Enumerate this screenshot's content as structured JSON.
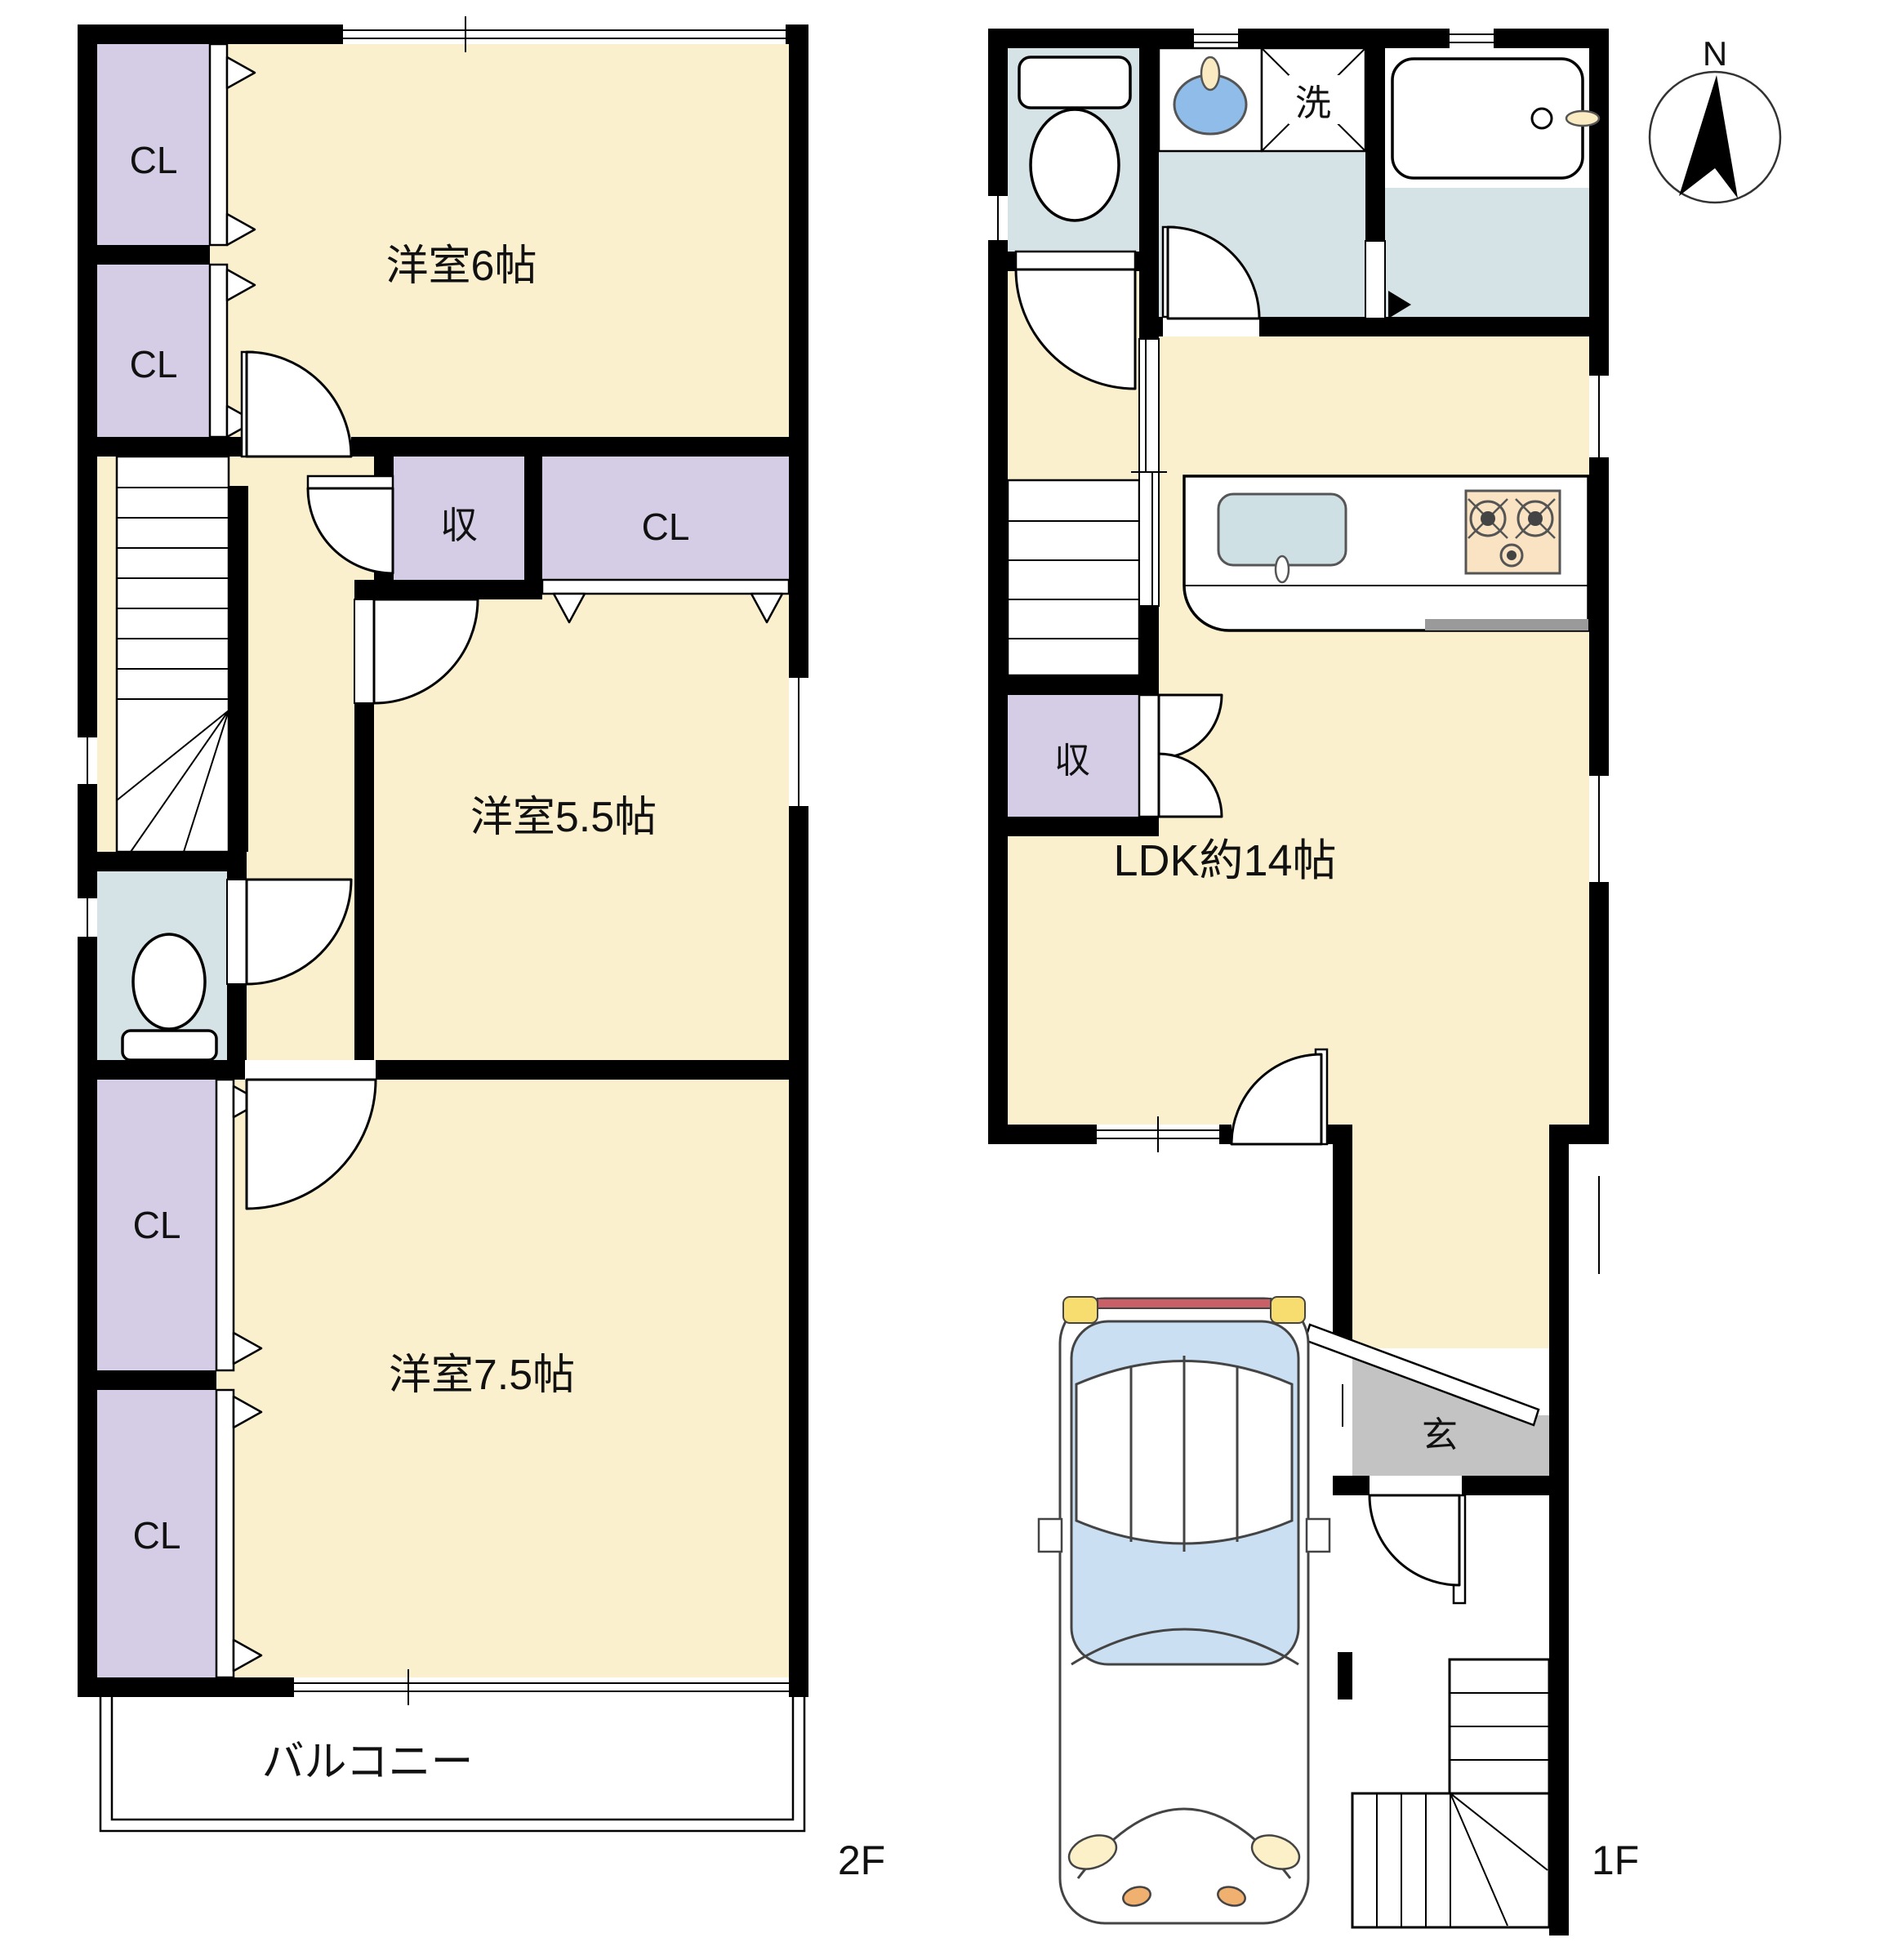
{
  "plan": {
    "compass": {
      "north_label": "N"
    },
    "floor2": {
      "label": "2F",
      "rooms": [
        {
          "name": "western-room-6",
          "label": "洋室6帖"
        },
        {
          "name": "western-room-5-5",
          "label": "洋室5.5帖"
        },
        {
          "name": "western-room-7-5",
          "label": "洋室7.5帖"
        },
        {
          "name": "balcony",
          "label": "バルコニー"
        }
      ],
      "storage": [
        {
          "name": "closet-top-1",
          "label": "CL"
        },
        {
          "name": "closet-top-2",
          "label": "CL"
        },
        {
          "name": "storage-mid",
          "label": "収"
        },
        {
          "name": "closet-mid",
          "label": "CL"
        },
        {
          "name": "closet-bottom-1",
          "label": "CL"
        },
        {
          "name": "closet-bottom-2",
          "label": "CL"
        }
      ]
    },
    "floor1": {
      "label": "1F",
      "rooms": [
        {
          "name": "ldk",
          "label": "LDK約14帖"
        },
        {
          "name": "entrance",
          "label": "玄"
        },
        {
          "name": "laundry",
          "label": "洗"
        },
        {
          "name": "storage-under-stairs",
          "label": "収"
        }
      ]
    },
    "colors": {
      "wall": "#000000",
      "room_floor": "#FBF0CE",
      "closet": "#D5CDE5",
      "wet_area_floor": "#D6E3E6",
      "entrance_floor": "#C3C3C3",
      "stove": "#FAE3C2",
      "basin": "#8FBCE8",
      "car_glass": "#CBDFF2",
      "car_tail_bar": "#C96068"
    }
  }
}
